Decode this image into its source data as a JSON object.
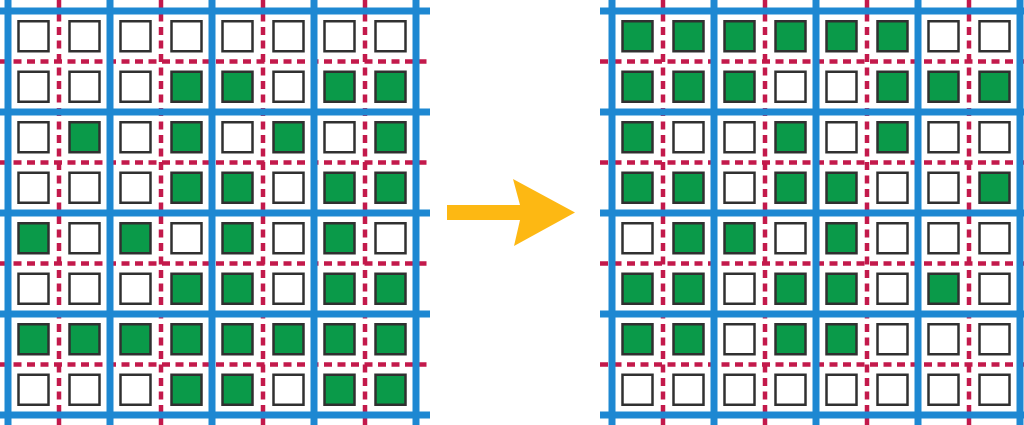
{
  "figure": {
    "type": "grid-transformation-diagram",
    "colors": {
      "grid_major_line": "#1E88D2",
      "grid_minor_line": "#C3194B",
      "filled_cell": "#0A9A49",
      "empty_cell": "#FFFFFF",
      "cell_border": "#303030",
      "arrow": "#FDB813",
      "background": "#FFFFFF"
    },
    "arrow": {
      "icon": "right-arrow-icon",
      "direction": "right"
    },
    "before_grid": {
      "rows": 8,
      "cols": 8,
      "cells": [
        [
          0,
          0,
          0,
          0,
          0,
          0,
          0,
          0
        ],
        [
          0,
          0,
          0,
          1,
          1,
          0,
          1,
          1
        ],
        [
          0,
          1,
          0,
          1,
          0,
          1,
          0,
          1
        ],
        [
          0,
          0,
          0,
          1,
          1,
          0,
          1,
          1
        ],
        [
          1,
          0,
          1,
          0,
          1,
          0,
          1,
          0
        ],
        [
          0,
          0,
          0,
          1,
          1,
          0,
          1,
          1
        ],
        [
          1,
          1,
          1,
          1,
          1,
          1,
          1,
          1
        ],
        [
          0,
          0,
          0,
          1,
          1,
          0,
          1,
          1
        ]
      ]
    },
    "after_grid": {
      "rows": 8,
      "cols": 8,
      "cells": [
        [
          1,
          1,
          1,
          1,
          1,
          1,
          0,
          0
        ],
        [
          1,
          1,
          1,
          0,
          0,
          1,
          1,
          1
        ],
        [
          1,
          0,
          0,
          1,
          0,
          1,
          0,
          0
        ],
        [
          1,
          1,
          0,
          1,
          1,
          0,
          0,
          1
        ],
        [
          0,
          1,
          1,
          0,
          1,
          0,
          0,
          0
        ],
        [
          1,
          1,
          0,
          1,
          1,
          0,
          1,
          0
        ],
        [
          1,
          1,
          0,
          1,
          1,
          0,
          0,
          0
        ],
        [
          0,
          0,
          0,
          0,
          0,
          0,
          0,
          0
        ]
      ]
    }
  }
}
